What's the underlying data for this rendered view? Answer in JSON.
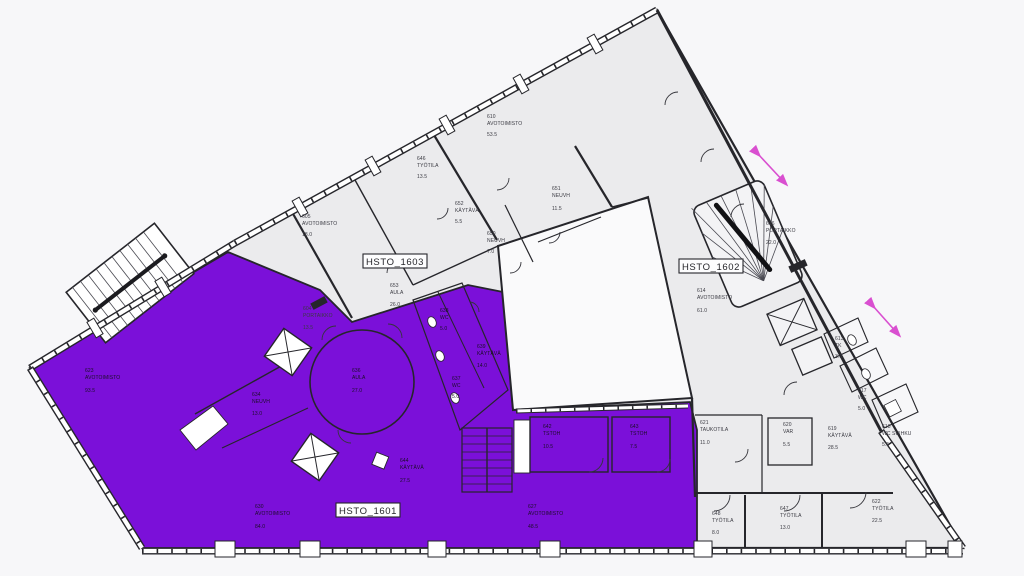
{
  "plan": {
    "units": [
      {
        "label": "HSTO_1603"
      },
      {
        "label": "HSTO_1602"
      },
      {
        "label": "HSTO_1601"
      }
    ],
    "rooms": [
      {
        "id": "605",
        "name": "AVOTOIMISTO",
        "area": "18.0"
      },
      {
        "id": "646",
        "name": "TYÖTILA",
        "area": "13.5"
      },
      {
        "id": "610",
        "name": "AVOTOIMISTO",
        "area": "53.5"
      },
      {
        "id": "652",
        "name": "KÄYTÄVÄ",
        "area": "5.5"
      },
      {
        "id": "651",
        "name": "NEUVH",
        "area": "11.5"
      },
      {
        "id": "650",
        "name": "NEUVH",
        "area": "7.0"
      },
      {
        "id": "653",
        "name": "AULA",
        "area": "26.0"
      },
      {
        "id": "604",
        "name": "PORTAIKKO",
        "area": "13.5"
      },
      {
        "id": "614",
        "name": "AVOTOIMISTO",
        "area": "61.0"
      },
      {
        "id": "616",
        "name": "PORTAIKKO",
        "area": "22.0"
      },
      {
        "id": "613",
        "name": "TK",
        "area": "3.0"
      },
      {
        "id": "617",
        "name": "WC",
        "area": "5.0"
      },
      {
        "id": "619",
        "name": "KÄYTÄVÄ",
        "area": "28.5"
      },
      {
        "id": "618",
        "name": "WC SUIHKU",
        "area": "5.5"
      },
      {
        "id": "620",
        "name": "VAR",
        "area": "5.5"
      },
      {
        "id": "621",
        "name": "TAUKOTILA",
        "area": "11.0"
      },
      {
        "id": "648",
        "name": "TYÖTILA",
        "area": "8.0"
      },
      {
        "id": "647",
        "name": "TYÖTILA",
        "area": "13.0"
      },
      {
        "id": "622",
        "name": "TYÖTILA",
        "area": "22.5"
      },
      {
        "id": "623",
        "name": "AVOTOIMISTO",
        "area": "93.5"
      },
      {
        "id": "634",
        "name": "NEUVH",
        "area": "13.0"
      },
      {
        "id": "636",
        "name": "AULA",
        "area": "27.0"
      },
      {
        "id": "638",
        "name": "WC",
        "area": "5.0"
      },
      {
        "id": "637",
        "name": "WC",
        "area": "5.0"
      },
      {
        "id": "639",
        "name": "KÄYTÄVÄ",
        "area": "14.0"
      },
      {
        "id": "642",
        "name": "TSTOH",
        "area": "10.5"
      },
      {
        "id": "643",
        "name": "TSTOH",
        "area": "7.5"
      },
      {
        "id": "644",
        "name": "KÄYTÄVÄ",
        "area": "27.5"
      },
      {
        "id": "630",
        "name": "AVOTOIMISTO",
        "area": "84.0"
      },
      {
        "id": "627",
        "name": "AVOTOIMISTO",
        "area": "48.5"
      }
    ],
    "colors": {
      "highlight_purple": "#7B10D9",
      "floor_grey": "#EBEBED",
      "wall_dark": "#26262B",
      "arrow_magenta": "#D94FD0"
    }
  }
}
